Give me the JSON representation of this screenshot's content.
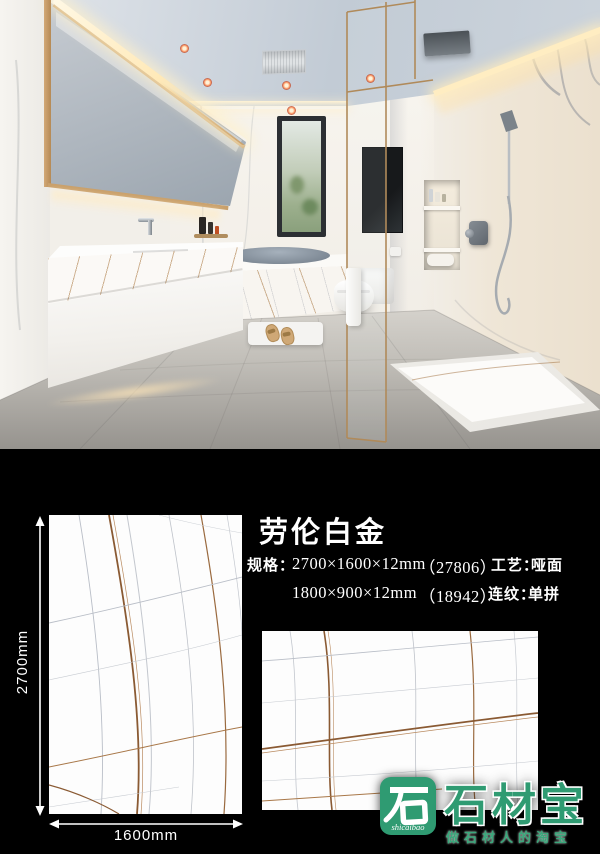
{
  "info_panel": {
    "title": "劳伦白金",
    "spec_label": "规格：",
    "specs": [
      {
        "size": "2700×1600×12mm",
        "code": "（27806）"
      },
      {
        "size": "1800×900×12mm",
        "code": "（18942）"
      }
    ],
    "finish_label": "工艺：",
    "finish_value": "哑面",
    "pattern_label": "连纹：",
    "pattern_value": "单拼",
    "dimension_height": "2700mm",
    "dimension_width": "1600mm"
  },
  "logo": {
    "brand": "石材宝",
    "latin": "shicaibao",
    "tagline": "做石材人的淘宝"
  },
  "colors": {
    "background": "#000000",
    "text": "#ffffff",
    "brand_green": "#2f9b72",
    "vein_brown": "#8a5a33",
    "vein_gray": "#b9bec7",
    "tile_white": "#fdfdfd"
  }
}
